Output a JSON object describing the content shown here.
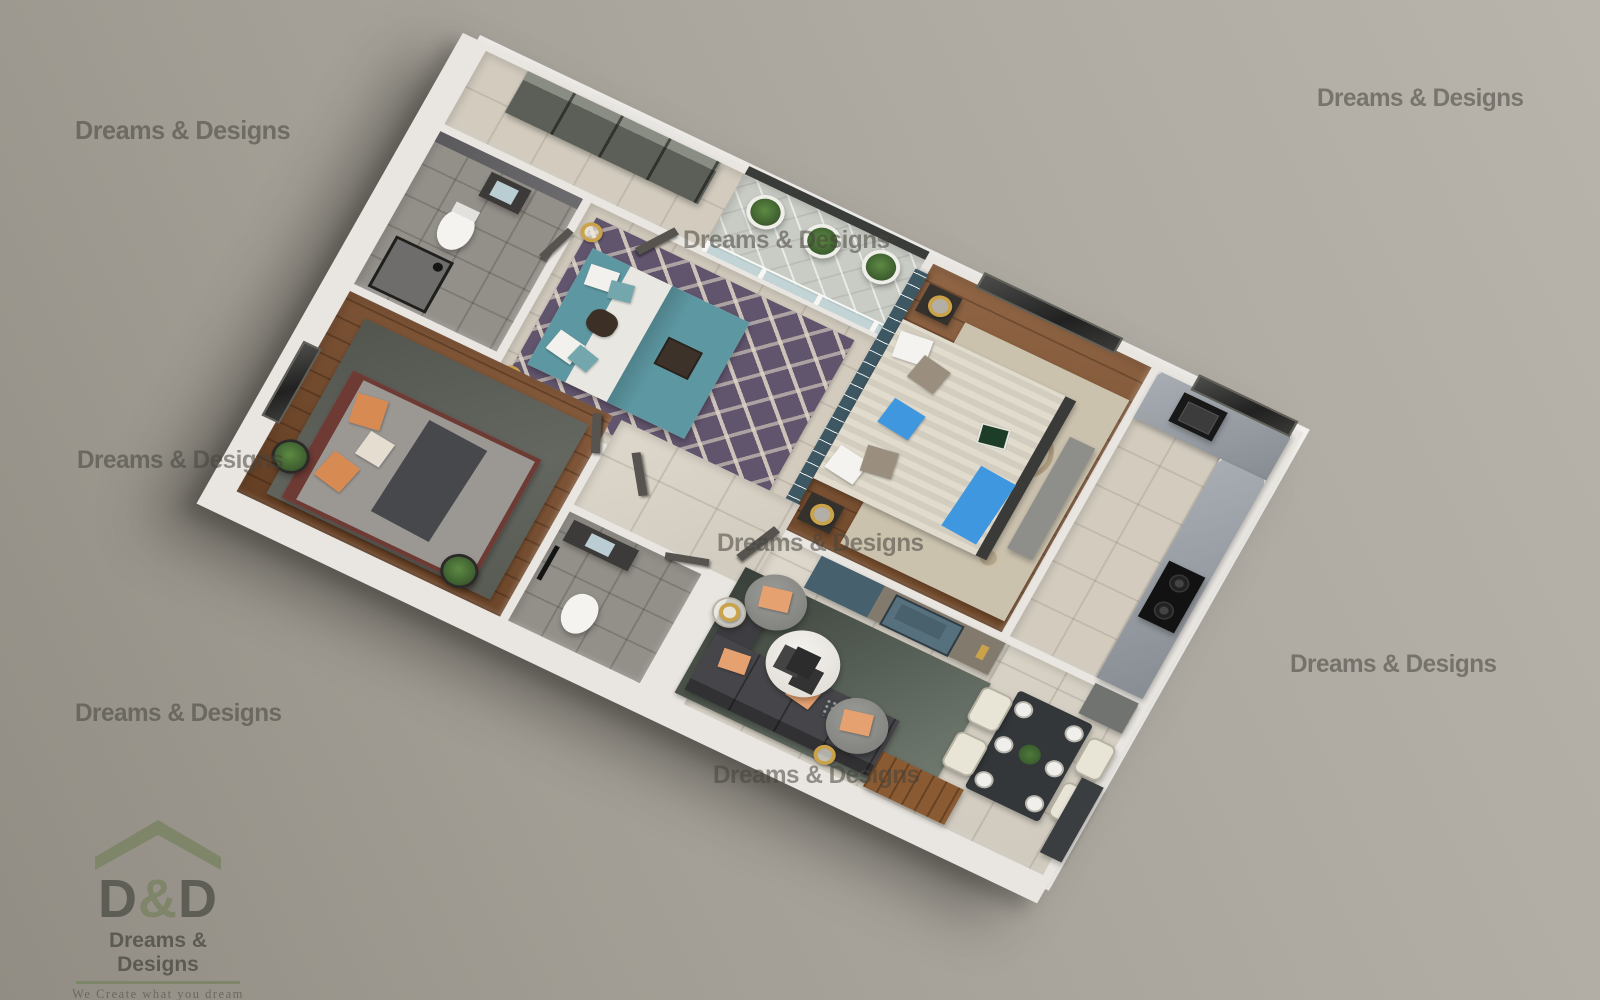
{
  "scene": {
    "description": "3D isometric render of a 2BHK apartment floor plan on a gray studio background",
    "background_color": "#aba79f",
    "rooms": [
      "dressing-wardrobes",
      "bathroom-1",
      "bedroom-2",
      "balcony",
      "master-bedroom",
      "kitchen",
      "bedroom-1",
      "bathroom-2",
      "hallway",
      "living-room",
      "dining-area",
      "entrance"
    ]
  },
  "watermark": {
    "text": "Dreams & Designs",
    "color": "#46433c"
  },
  "logo": {
    "monogram_left": "D",
    "monogram_amp": "&",
    "monogram_right": "D",
    "company": "Dreams & Designs",
    "tagline": "We Create what you dream",
    "phone": "Tel : +919835307058",
    "roof_color": "#7b8465",
    "text_color": "#55544c"
  },
  "palette": {
    "wall_white": "#f3f1ed",
    "floor_tile_cream": "#d8d2c6",
    "floor_wood": "#835430",
    "rug_purple": "#61546d",
    "rug_beige": "#cbc2ae",
    "rug_dark": "#53554f",
    "accent_teal": "#5d98a2",
    "accent_blue": "#3f97e0",
    "pillow_peach": "#e6a171",
    "counter_marble": "#9aa0a6",
    "gold": "#c9a24a"
  }
}
